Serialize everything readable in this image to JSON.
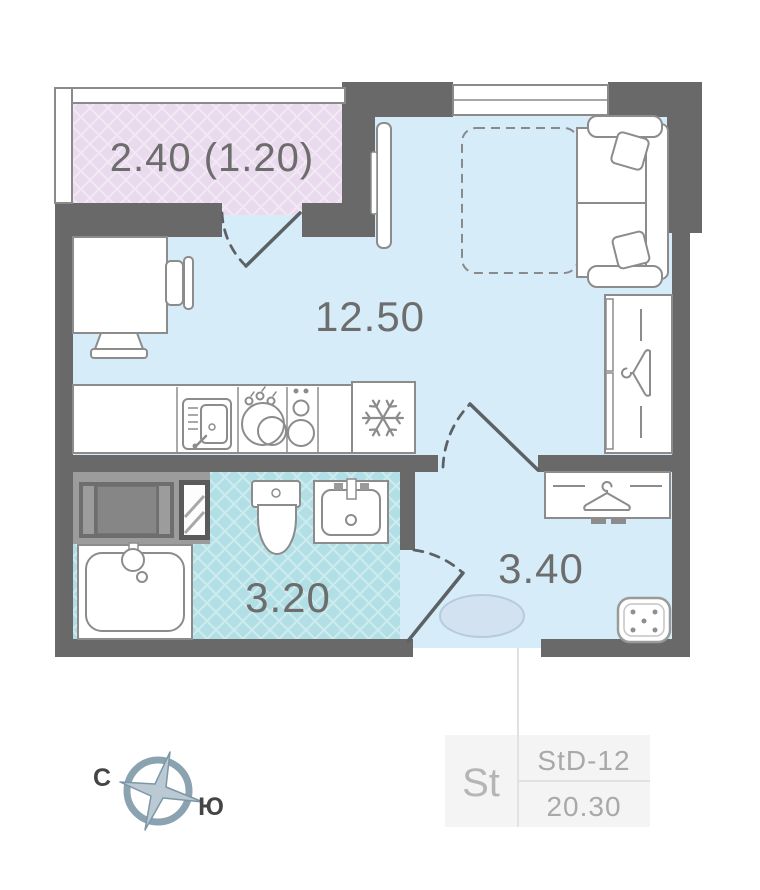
{
  "plan": {
    "rooms": [
      {
        "name": "balcony",
        "area_label": "2.40 (1.20)"
      },
      {
        "name": "living-kitchen",
        "area_label": "12.50"
      },
      {
        "name": "bathroom",
        "area_label": "3.20"
      },
      {
        "name": "hallway",
        "area_label": "3.40"
      }
    ],
    "compass": {
      "north": "С",
      "south": "Ю"
    },
    "unit_card": {
      "type": "St",
      "layout_code": "StD-12",
      "area_total": "20.30"
    },
    "colors": {
      "walls": "#696969",
      "floor_main": "#d7ecf9",
      "floor_balcony": "#e9daed",
      "floor_bathroom": "#b2dfe5",
      "furniture_outline": "#8c8c8c",
      "door_lines": "#5c6166",
      "label_text": "#6d6d6d",
      "card_background": "#f4f4f4",
      "card_text": "#a9a9a9",
      "compass_ring": "#8ba2b0"
    }
  }
}
